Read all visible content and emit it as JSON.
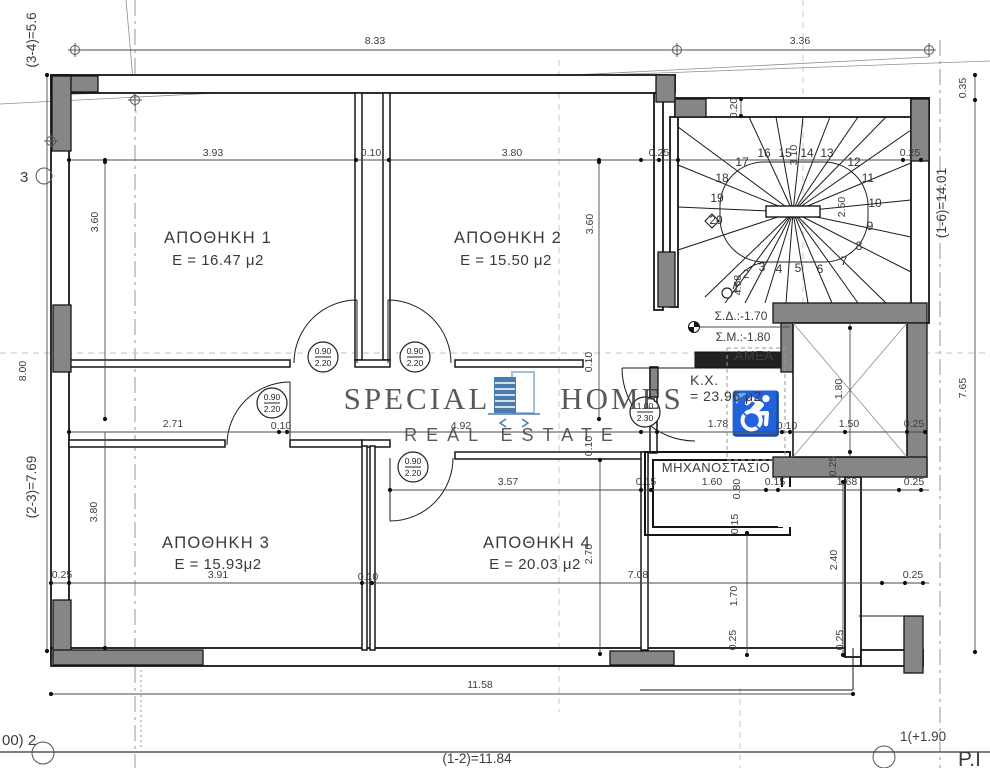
{
  "drawing_title": "basement-storage-floor-plan",
  "watermark": {
    "word1": "SPECIAL",
    "word2": "HOMES",
    "line2": "REAL ESTATE",
    "color": "#2b679e",
    "color_light": "#8cb6d9"
  },
  "rooms": {
    "r1": {
      "name": "ΑΠΟΘΗΚΗ 1",
      "area": "E = 16.47 μ2"
    },
    "r2": {
      "name": "ΑΠΟΘΗΚΗ 2",
      "area": "E = 15.50 μ2"
    },
    "r3": {
      "name": "ΑΠΟΘΗΚΗ 3",
      "area": "E = 15.93μ2"
    },
    "r4": {
      "name": "ΑΠΟΘΗΚΗ 4",
      "area": "E = 20.03 μ2"
    },
    "machine": {
      "name": "ΜΗΧΑΝΟΣΤΑΣΙΟ"
    },
    "amea": {
      "name": "ΑΜΕΑ"
    },
    "kx": {
      "name": "K.X.",
      "area": "= 23.96 μ2"
    }
  },
  "levels": {
    "sd": "Σ.Δ.:-1.70",
    "sm": "Σ.Μ.:-1.80"
  },
  "doors": {
    "d90": {
      "w": "0.90",
      "h": "2.20"
    },
    "d100": {
      "w": "1.00",
      "h": "2.30"
    }
  },
  "stairs": {
    "steps": [
      "1",
      "2",
      "3",
      "4",
      "5",
      "6",
      "7",
      "8",
      "9",
      "10",
      "11",
      "12",
      "13",
      "14",
      "15",
      "16",
      "17",
      "18",
      "19",
      "20"
    ]
  },
  "axes": {
    "left_top": "(3-4)=5.6",
    "left_mid": "8.00",
    "left_bot": "(2-3)=7.69",
    "grid3": "3",
    "right_total": "(1-6)=14.01",
    "right_top": "0.35",
    "right_bot": "7.65",
    "bottom_total": "(1-2)=11.84",
    "grid2": "00) 2",
    "grid1": "1(+1.90",
    "pi": "P.I"
  },
  "dims": {
    "v833": "8.33",
    "v336": "3.36",
    "v393": "3.93",
    "v380": "3.80",
    "v010": "0.10",
    "v025": "0.25",
    "v360": "3.60",
    "v020": "0.20",
    "v271": "2.71",
    "v492": "4.92",
    "v178": "1.78",
    "v150": "1.50",
    "v180": "1.80",
    "v357": "3.57",
    "v015": "0.15",
    "v160": "1.60",
    "v080": "0.80",
    "v168": "1.68",
    "v270": "2.70",
    "v708": "7.08",
    "v391": "3.91",
    "v240": "2.40",
    "v170": "1.70",
    "v1158": "11.58",
    "v250": "2.50",
    "v310": "3.10",
    "v458": "4.58"
  },
  "icons": {
    "wheelchair": "♿"
  }
}
